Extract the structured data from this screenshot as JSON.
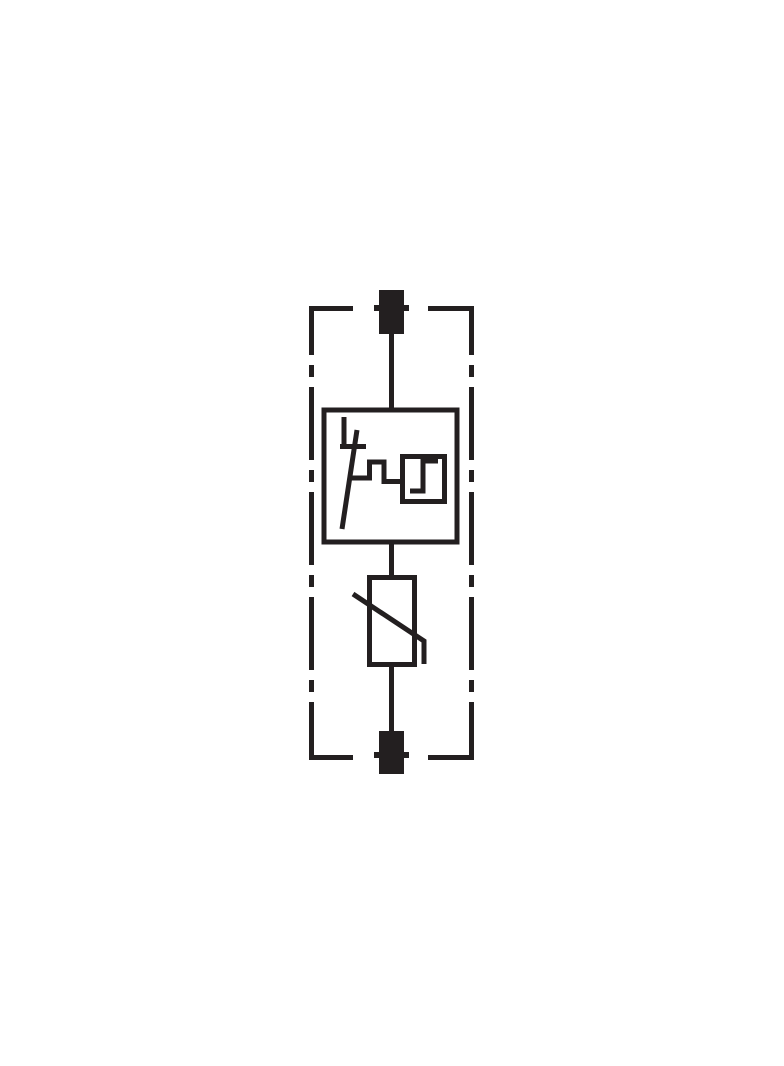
{
  "diagram": {
    "title": "Surge protective device circuit diagram",
    "type": "electrical-schematic",
    "ink_color": "#231f20",
    "background_color": "#ffffff",
    "components": [
      {
        "id": "top-terminal",
        "label": "upper connection terminal",
        "symbol": "filled terminal block with side lugs"
      },
      {
        "id": "device-enclosure",
        "label": "device housing boundary",
        "symbol": "dash-dot rectangular outline interrupted at terminals"
      },
      {
        "id": "thermal-disconnector",
        "label": "thermal disconnect device with function monitoring",
        "symbol": "boxed disconnect switch linked to step-function monitor box"
      },
      {
        "id": "function-monitor",
        "label": "function monitoring indicator",
        "symbol": "small box with step-function glyph"
      },
      {
        "id": "varistor",
        "label": "metal-oxide varistor",
        "symbol": "rectangle crossed by diagonal line with bent foot"
      },
      {
        "id": "bottom-terminal",
        "label": "lower connection terminal",
        "symbol": "filled terminal block with side lugs"
      }
    ]
  }
}
